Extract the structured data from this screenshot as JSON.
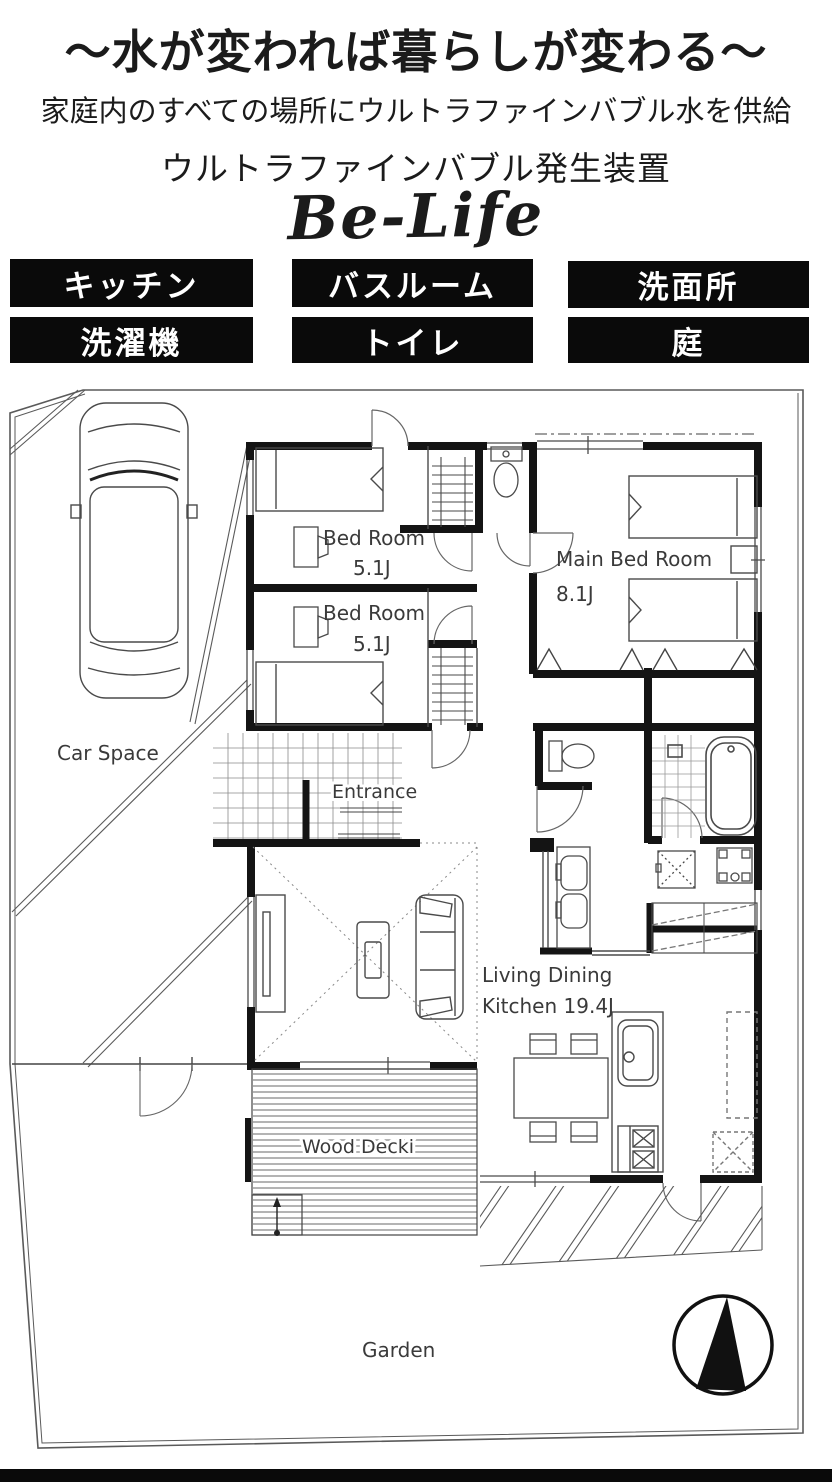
{
  "header": {
    "tagline": "～水が変われば暮らしが変わる～",
    "subtitle": "家庭内のすべての場所にウルトラファインバブル水を供給",
    "device_title": "ウルトラファインバブル発生装置",
    "brand": "Be-Life"
  },
  "feature_labels": [
    "キッチン",
    "バスルーム",
    "洗面所",
    "洗濯機",
    "トイレ",
    "庭"
  ],
  "floor_plan": {
    "rooms": {
      "bedroom1_name": "Bed Room",
      "bedroom1_size": "5.1J",
      "bedroom2_name": "Bed Room",
      "bedroom2_size": "5.1J",
      "main_bedroom_name": "Main Bed Room",
      "main_bedroom_size": "8.1J",
      "ldk_line1": "Living Dining",
      "ldk_line2": "Kitchen 19.4J",
      "entrance": "Entrance",
      "wood_deck": "Wood Decki",
      "car_space": "Car Space",
      "garden": "Garden"
    },
    "colors": {
      "wall": "#141414",
      "line": "#4a4a4a",
      "accent": "#0a0a0a"
    }
  }
}
